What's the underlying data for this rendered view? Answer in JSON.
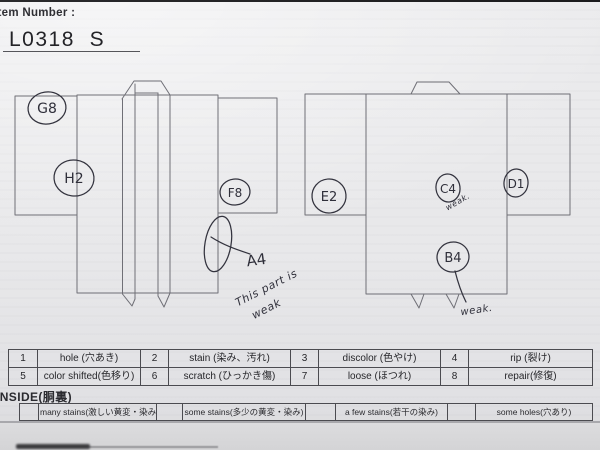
{
  "header": {
    "item_number_label": "Item Number :",
    "item_number_value": "L0318  S"
  },
  "annotations": {
    "front": {
      "g8": "G8",
      "h2": "H2",
      "f8": "F8",
      "a4": "A4",
      "a4_note_line1": "This part is",
      "a4_note_line2": "weak"
    },
    "back": {
      "e2": "E2",
      "c4": "C4",
      "c4_note": "weak.",
      "d1": "D1",
      "b4": "B4",
      "b4_note": "weak."
    }
  },
  "defect_table": {
    "rows": [
      {
        "cells": [
          {
            "num": "1",
            "label": "hole (穴あき)"
          },
          {
            "num": "2",
            "label": "stain (染み、汚れ)"
          },
          {
            "num": "3",
            "label": "discolor (色やけ)"
          },
          {
            "num": "4",
            "label": "rip (裂け)"
          }
        ]
      },
      {
        "cells": [
          {
            "num": "5",
            "label": "color shifted(色移り)"
          },
          {
            "num": "6",
            "label": "scratch (ひっかき傷)"
          },
          {
            "num": "7",
            "label": "loose (ほつれ)"
          },
          {
            "num": "8",
            "label": "repair(修復)"
          }
        ]
      }
    ]
  },
  "inside": {
    "title": "INSIDE(胴裏)",
    "cells": [
      "many stains(激しい黄変・染み)",
      "some stains(多少の黄変・染み)",
      "a few stains(若干の染み)",
      "some holes(穴あり)"
    ]
  },
  "colors": {
    "paper": "#e9e9eb",
    "pencil_line": "#6f6f76",
    "ink": "#33333e",
    "table_border": "#4b4b50",
    "photo_top_edge": "#1b1b1d"
  }
}
